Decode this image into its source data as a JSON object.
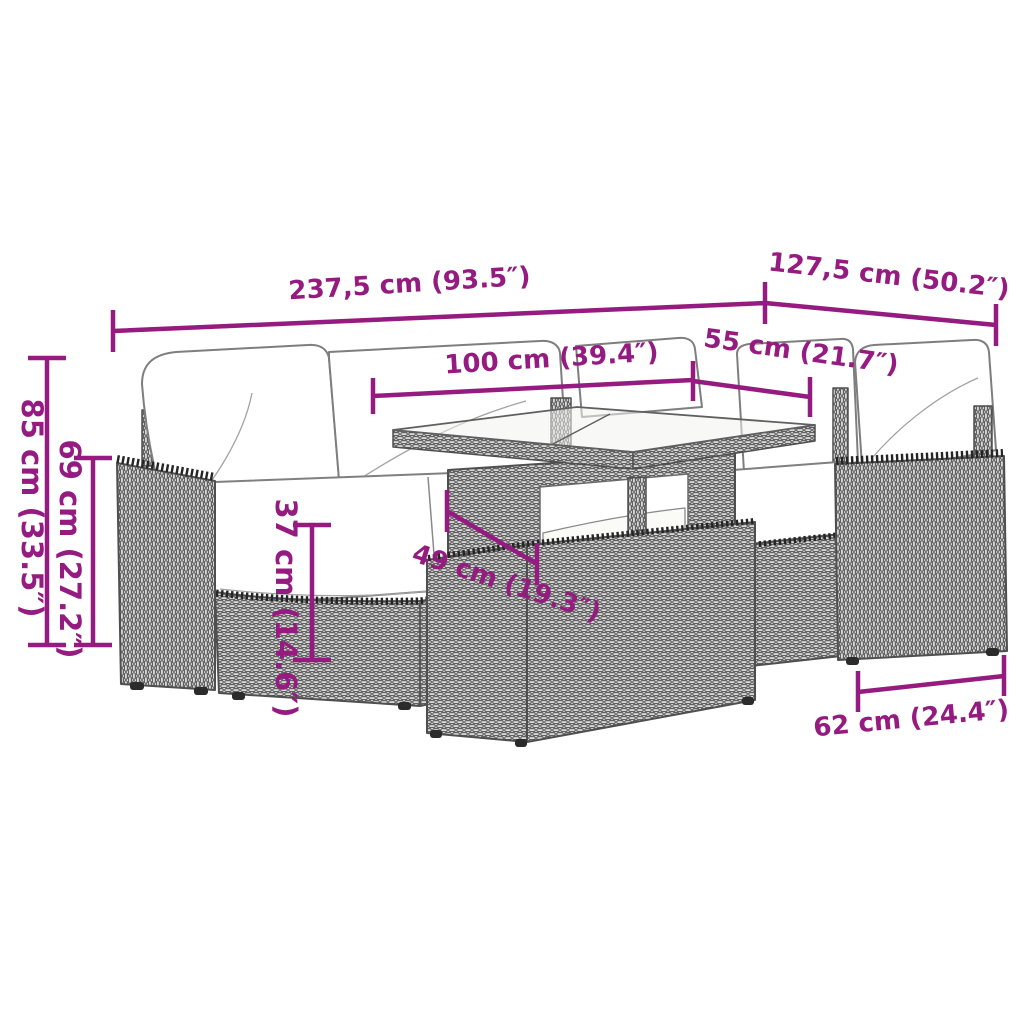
{
  "diagram": {
    "accent_color": "#951b81",
    "drawing_color": "#4f4f4f",
    "background_color": "#ffffff",
    "labels": {
      "overall_width": "237,5 cm (93.5″)",
      "overall_depth": "127,5 cm (50.2″)",
      "table_length": "100 cm (39.4″)",
      "seat_depth": "55 cm (21.7″)",
      "back_height": "85 cm (33.5″)",
      "armrest_height": "69 cm (27.2″)",
      "seat_height": "37 cm (14.6″)",
      "table_gap_height": "49 cm (19.3″)",
      "module_width": "62 cm (24.4″)"
    }
  }
}
